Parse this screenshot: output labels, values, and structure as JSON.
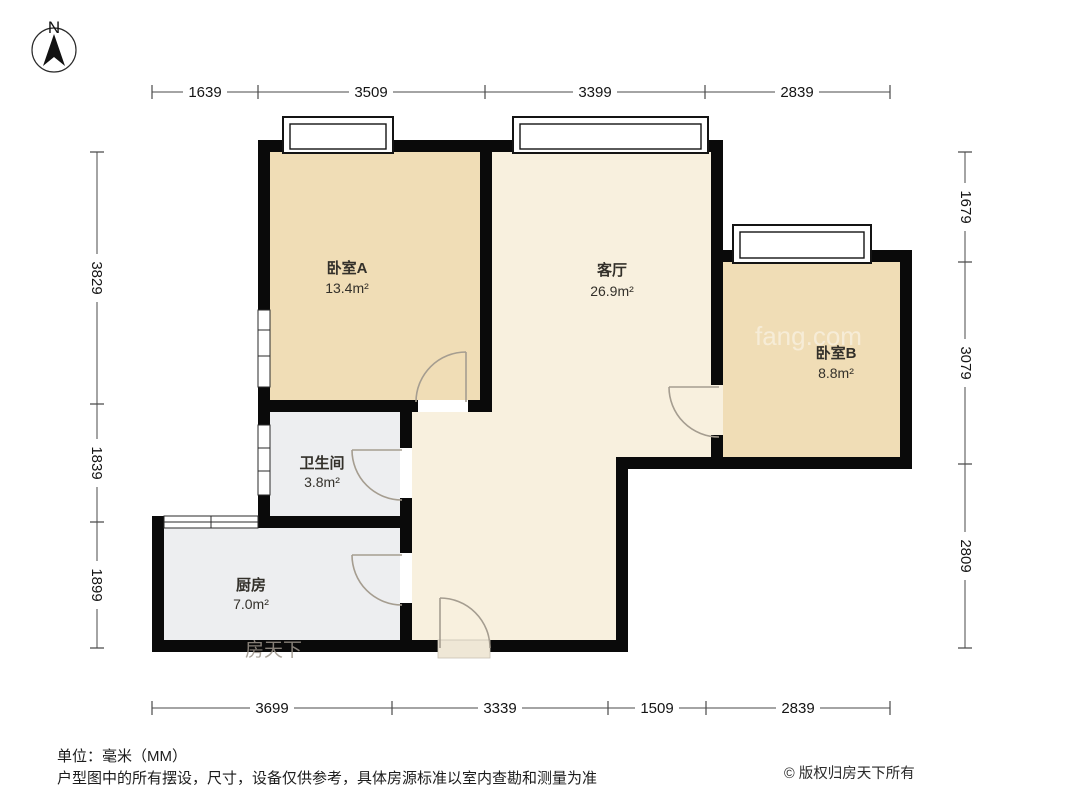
{
  "compass": {
    "north_label": "N"
  },
  "dimensions": {
    "top": [
      "1639",
      "3509",
      "3399",
      "2839"
    ],
    "bottom": [
      "3699",
      "3339",
      "1509",
      "2839"
    ],
    "left": [
      "3829",
      "1839",
      "1899"
    ],
    "right": [
      "1679",
      "3079",
      "2809"
    ]
  },
  "rooms": {
    "bedroom_a": {
      "name": "卧室A",
      "area": "13.4m²"
    },
    "living": {
      "name": "客厅",
      "area": "26.9m²"
    },
    "bedroom_b": {
      "name": "卧室B",
      "area": "8.8m²"
    },
    "bathroom": {
      "name": "卫生间",
      "area": "3.8m²"
    },
    "kitchen": {
      "name": "厨房",
      "area": "7.0m²"
    }
  },
  "watermarks": {
    "brand": "房天下",
    "domain": "fang.com"
  },
  "footer": {
    "unit_note": "单位：毫米（MM）",
    "disclaimer": "户型图中的所有摆设，尺寸，设备仅供参考，具体房源标准以室内查勘和测量为准",
    "copyright": "© 版权归房天下所有"
  },
  "colors": {
    "bedroom": "#F0DDB6",
    "living": "#F8F0DE",
    "service": "#EDEEF0",
    "wall": "#0A0A0A",
    "door": "#A59D90",
    "threshold": "#EFE7D6"
  }
}
